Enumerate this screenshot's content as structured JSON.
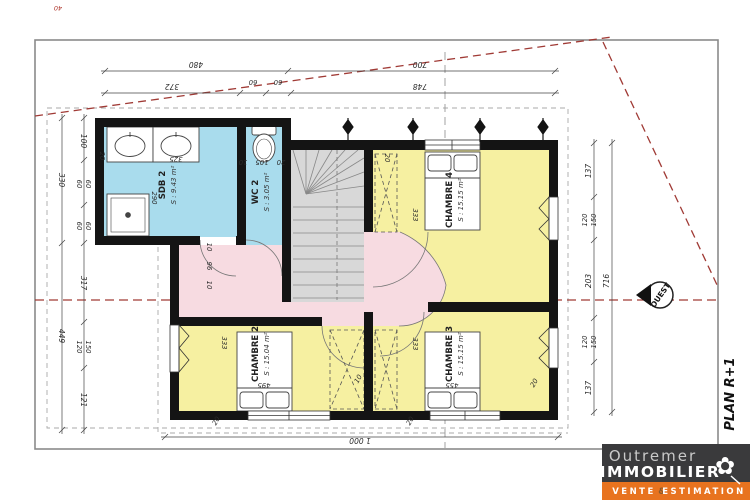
{
  "plan": {
    "label": "PLAN R+1"
  },
  "compass": {
    "label": "OUEST"
  },
  "corner_mark": "40",
  "rooms": {
    "sdb2": {
      "name": "SDB 2",
      "area": "S : 9.43 m²"
    },
    "wc2": {
      "name": "WC 2",
      "area": "S : 3.05 m²"
    },
    "ch4": {
      "name": "CHAMBRE 4",
      "area": "S : 15.15 m²"
    },
    "ch2": {
      "name": "CHAMBRE 2",
      "area": "S : 15.04 m²"
    },
    "ch3": {
      "name": "CHAMBRE 3",
      "area": "S : 15.15 m²"
    }
  },
  "dims": {
    "top1_left": "480",
    "top1_right": "700",
    "top2_a": "372",
    "top2_b": "60",
    "top2_c": "60",
    "top2_d": "748",
    "bottom_total": "1 000",
    "left_outer_top": "330",
    "left_outer_bottom": "449",
    "left_a": "100",
    "left_b": "60",
    "left_c": "60",
    "left_d": "60",
    "left_e": "60",
    "left_f": "317",
    "left_g": "120",
    "left_h": "150",
    "left_i": "121",
    "right_a": "137",
    "right_b": "120",
    "right_c": "150",
    "right_d": "203",
    "right_e": "120",
    "right_f": "150",
    "right_g": "137",
    "right_total": "716",
    "sdb_width": "325",
    "sdb_height": "290",
    "wall_20_left": "20",
    "wc_a": "10",
    "wc_b": "105",
    "wc_c": "20",
    "ch4_top": "20",
    "ch4_side": "333",
    "hall_a": "10",
    "hall_b": "96",
    "hall_c": "10",
    "ch2_side": "333",
    "ch3_side": "333",
    "bed2_width": "495",
    "bed3_width": "455",
    "ward_gap": "10",
    "ch3_corner": "20",
    "bottom_wall_a": "20",
    "bottom_wall_b": "20"
  },
  "logo": {
    "name_line1": "Outremer",
    "name_line2": "IMMOBILIER",
    "tag_word1": "VENTE",
    "tag_amp": "&",
    "tag_word2": "ESTIMATION"
  },
  "colors": {
    "room_wet": "#a9dced",
    "room_bedroom": "#f6f0a1",
    "hall": "#f7dbe1",
    "stairs": "#d8d8d8",
    "wall": "#141414",
    "logo_orange": "#e8731f",
    "boundary_red": "#a03a35"
  }
}
